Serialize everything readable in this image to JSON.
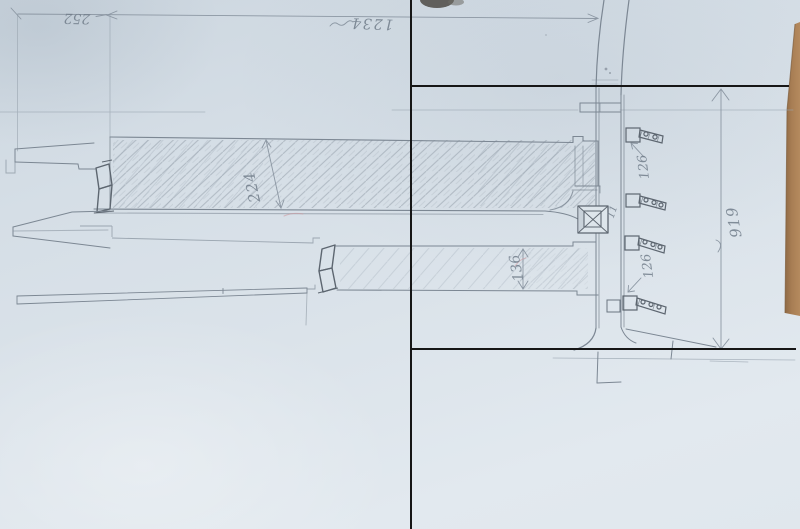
{
  "annotations": {
    "top_left_width": "252",
    "top_overall_width": "1234",
    "upper_beam_depth": "224",
    "lower_beam_depth": "136",
    "bracket_spacing_upper": "126",
    "bracket_spacing_lower": "126",
    "right_overall_height": "919",
    "pier_mark": "11"
  },
  "colors": {
    "paper": "#dbe3ea",
    "pencil": "#7c8793",
    "pencil_faint": "#9aa5b0",
    "pencil_dark": "#5d6670",
    "overlay_black": "#161616",
    "desk_wood": "#a87e54",
    "red_pencil": "#cf9ba1"
  }
}
